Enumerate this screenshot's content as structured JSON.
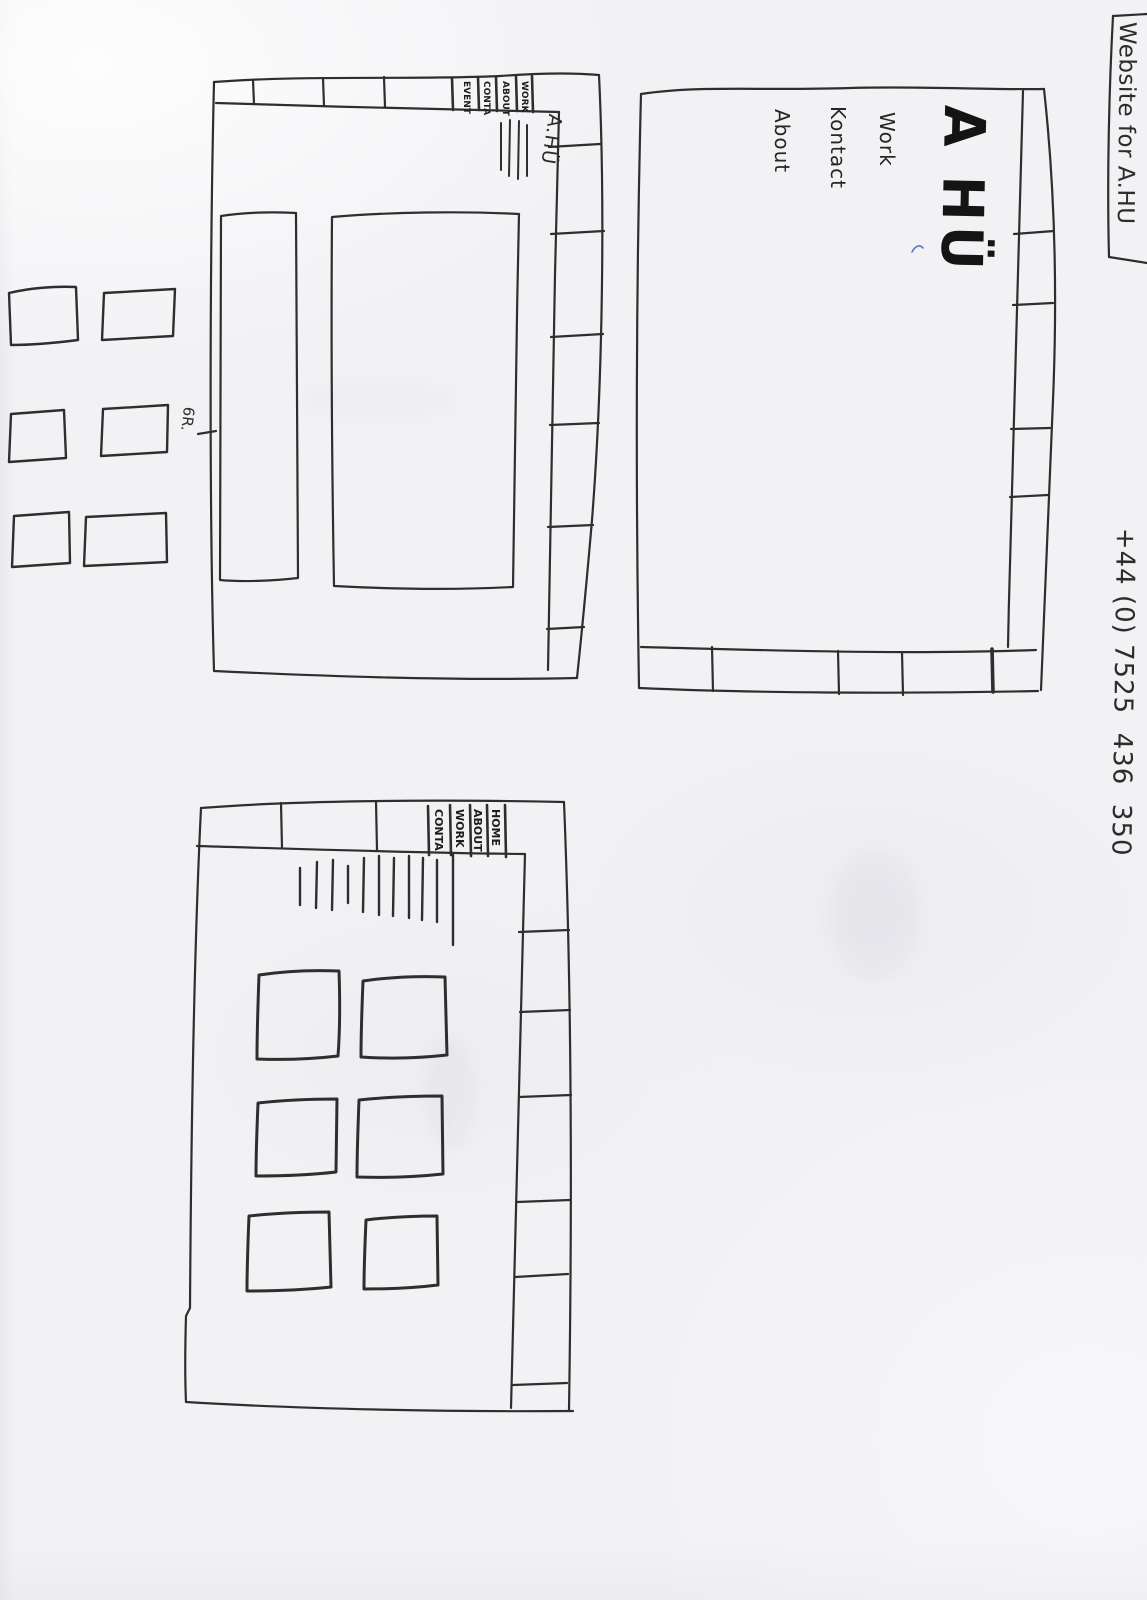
{
  "page": {
    "note_box_text": "Website for A.HU",
    "phone": "+44 (0) 7525  436  350",
    "row_marker": "6R."
  },
  "home_wireframe": {
    "logo": "A HÜ",
    "nav": [
      "Work",
      "Kontact",
      "About"
    ]
  },
  "content_wireframe": {
    "logo": "A.HÜ",
    "nav": [
      "EVENT",
      "CONTA",
      "ABOUT",
      "WORK"
    ]
  },
  "gallery_wireframe": {
    "nav": [
      "CONTA",
      "WORK",
      "ABOUT",
      "HOME"
    ]
  },
  "colors": {
    "ink": "#2e2e2e",
    "marker_ink": "#141414",
    "blue_mark": "#5577cc",
    "paper": "#f2f2f5"
  }
}
